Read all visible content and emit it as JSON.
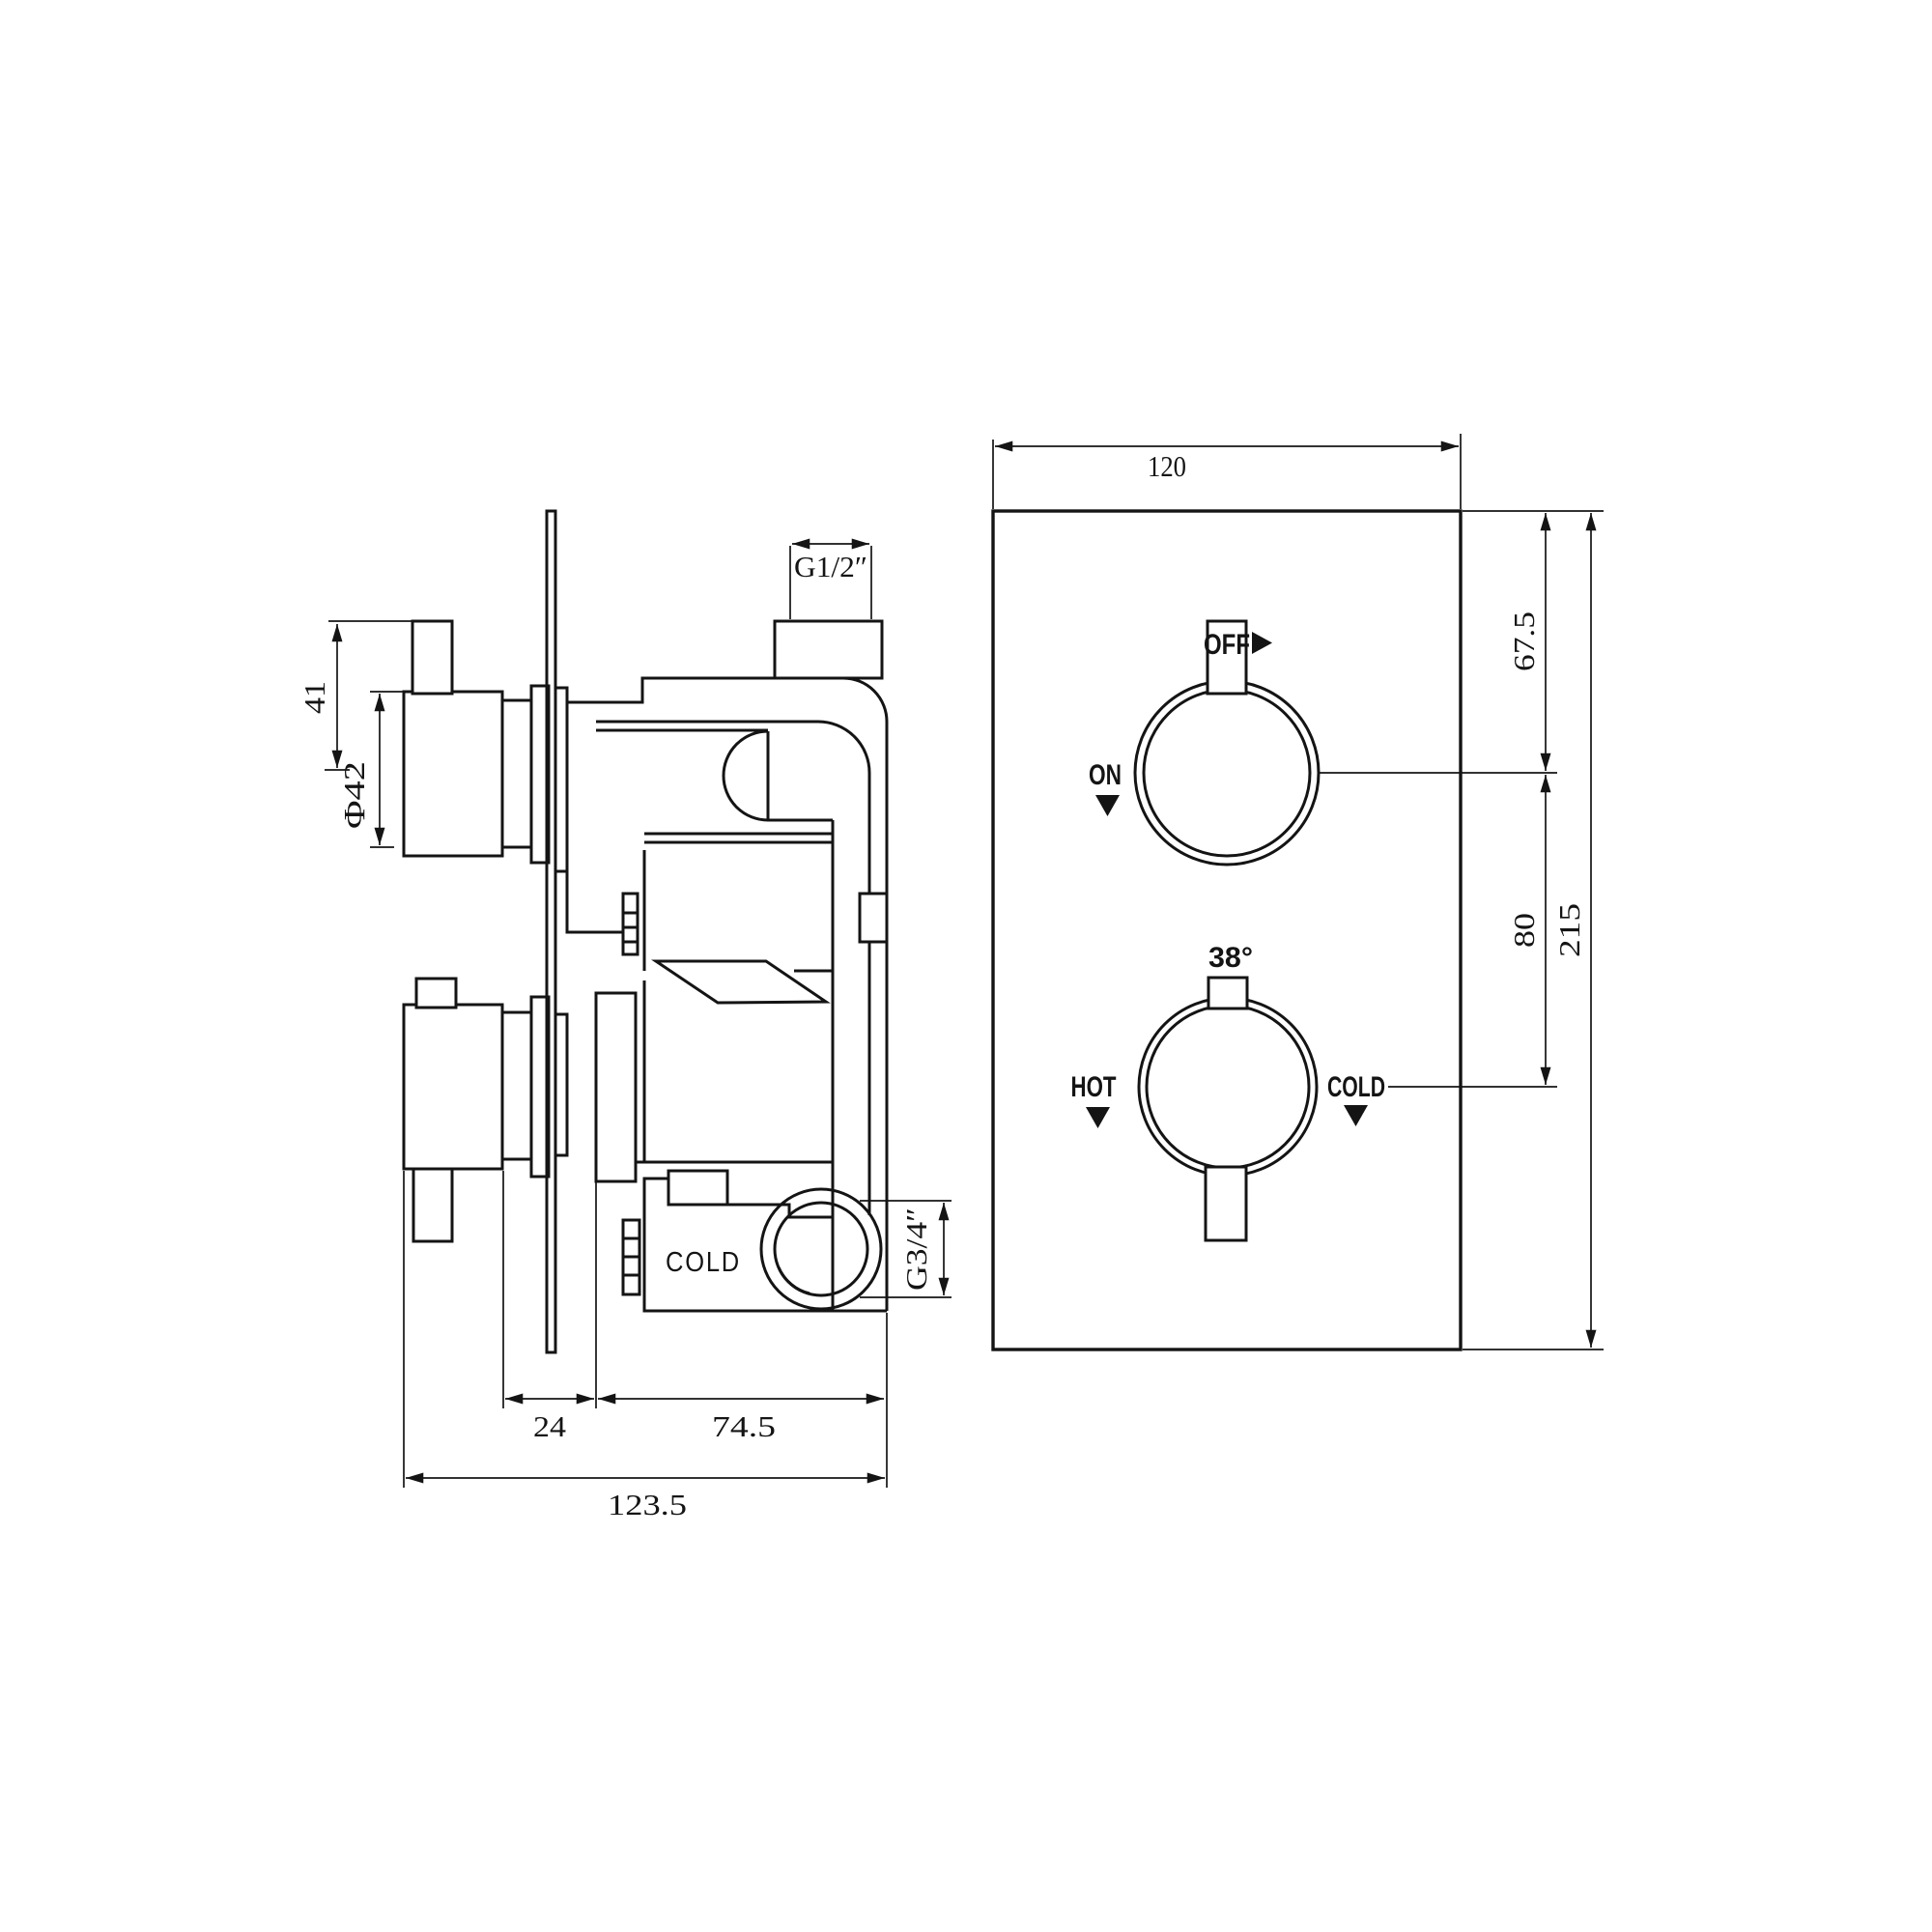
{
  "drawing_type": "thermostatic shower valve technical drawing",
  "front_view": {
    "dim_width": "120",
    "dim_knob1_offset": "67.5",
    "dim_knob_spacing": "80",
    "dim_height": "215",
    "on_off_knob": {
      "off_label": "OFF",
      "on_label": "ON",
      "off_arrow_icon": "right-triangle",
      "on_arrow_icon": "down-triangle"
    },
    "temperature_knob": {
      "temp_label": "38°",
      "hot_label": "HOT",
      "cold_label": "COLD",
      "hot_arrow_icon": "down-triangle",
      "cold_arrow_icon": "down-triangle"
    }
  },
  "side_view": {
    "dim_handle_length": "41",
    "dim_handle_diameter": "Φ42",
    "thread_top_outlet": "G1/2″",
    "cold_inlet_label": "COLD",
    "thread_bottom_inlet": "G3/4″",
    "dim_handle_to_body": "24",
    "dim_body_depth": "74.5",
    "dim_total_depth": "123.5"
  },
  "colors": {
    "line": "#141414",
    "background": "#ffffff"
  }
}
